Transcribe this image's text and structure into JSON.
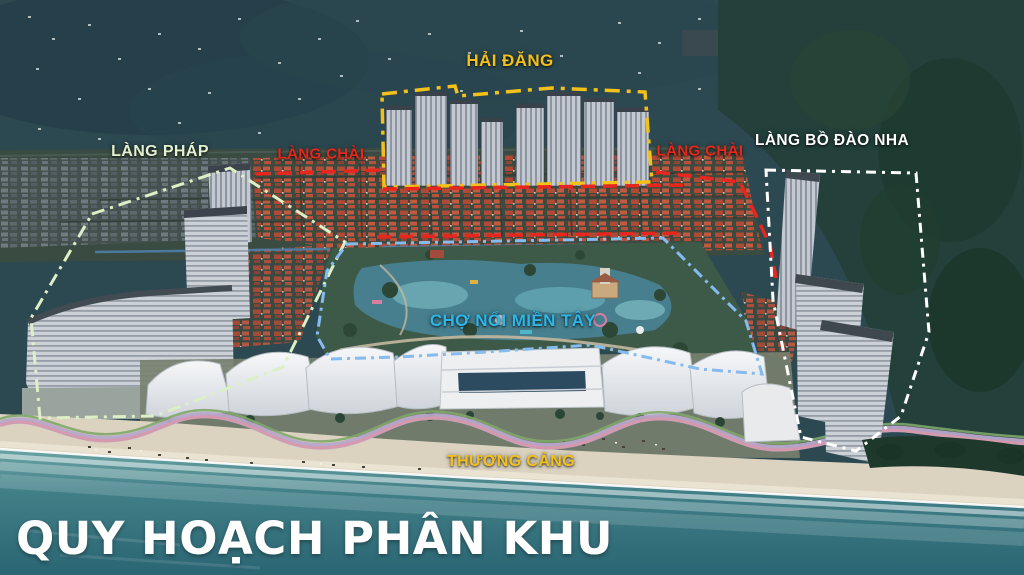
{
  "scene": {
    "title": {
      "text": "QUY HOẠCH PHÂN KHU",
      "color": "#ffffff"
    }
  },
  "zones": {
    "hai_dang": {
      "label": "HẢI ĐĂNG",
      "color": "#f3c119",
      "outline_color": "#f3c119"
    },
    "lang_phap": {
      "label": "LÀNG PHÁP",
      "color": "#e4f1d0",
      "outline_color": "#dcefc6"
    },
    "lang_chai_left": {
      "label": "LÀNG CHÀI",
      "color": "#e8261d",
      "outline_color": "#e8261d"
    },
    "lang_chai_right": {
      "label": "LÀNG CHÀI",
      "color": "#e8261d",
      "outline_color": "#e8261d"
    },
    "lang_bo_dao_nha": {
      "label": "LÀNG BỒ ĐÀO NHA",
      "color": "#ffffff",
      "outline_color": "#ffffff"
    },
    "cho_noi_mien_tay": {
      "label": "CHỢ NỔI MIỀN TÂY",
      "color": "#2eb6e9",
      "outline_color": "#85bbee"
    },
    "thuong_cang": {
      "label": "THƯƠNG CẢNG",
      "color": "#f3c119",
      "outline_color": "#f3c119"
    }
  }
}
